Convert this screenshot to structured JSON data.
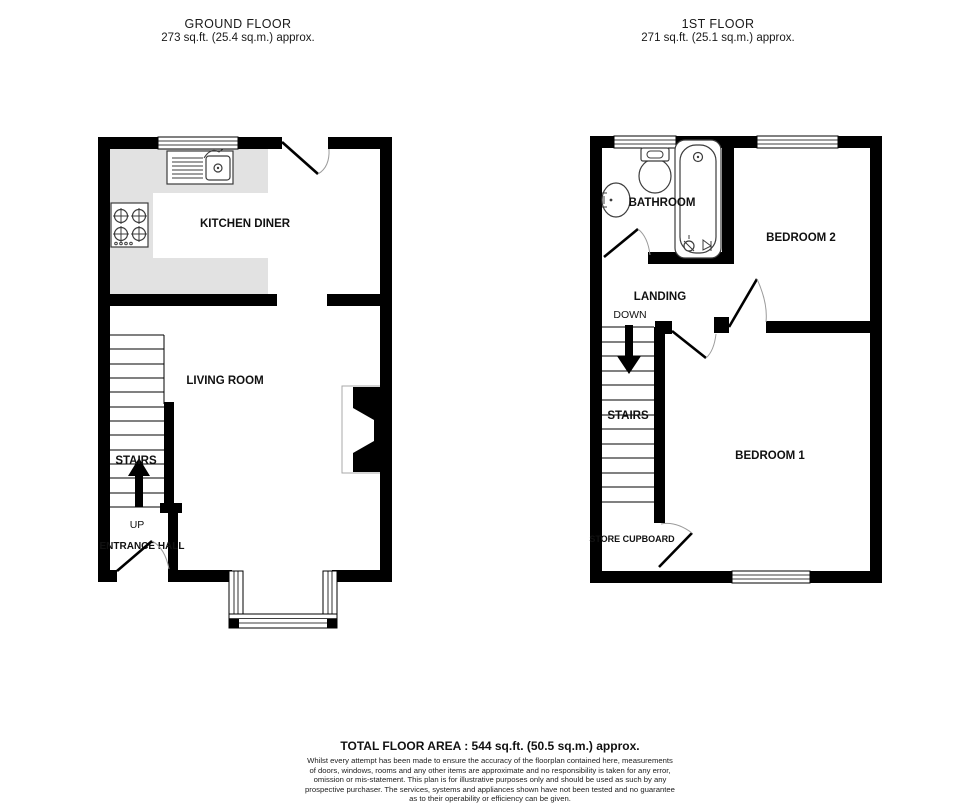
{
  "ground_floor": {
    "title": "GROUND FLOOR",
    "area": "273 sq.ft. (25.4 sq.m.) approx.",
    "labels": {
      "kitchen": "KITCHEN DINER",
      "living": "LIVING ROOM",
      "stairs": "STAIRS",
      "up": "UP",
      "hall": "ENTRANCE HALL"
    }
  },
  "first_floor": {
    "title": "1ST FLOOR",
    "area": "271 sq.ft. (25.1 sq.m.) approx.",
    "labels": {
      "bathroom": "BATHROOM",
      "bedroom2": "BEDROOM 2",
      "landing": "LANDING",
      "down": "DOWN",
      "stairs": "STAIRS",
      "bedroom1": "BEDROOM 1",
      "cupboard": "STORE CUPBOARD"
    }
  },
  "footer": {
    "total": "TOTAL FLOOR AREA : 544 sq.ft. (50.5 sq.m.) approx.",
    "disclaimer_lines": [
      "Whilst every attempt has been made to ensure the accuracy of the floorplan contained here, measurements",
      "of doors, windows, rooms and any other items are approximate and no responsibility is taken for any error,",
      "omission or mis-statement. This plan is for illustrative purposes only and should be used as such by any",
      "prospective purchaser. The services, systems and appliances shown have not been tested and no guarantee",
      "as to their operability or efficiency can be given.",
      "Made with Metropix ©2025"
    ]
  },
  "colors": {
    "wall": "#000000",
    "kitchen_counter": "#e2e2e2",
    "fixture_outline": "#3c3c3c",
    "door_arc": "#9b9b9b"
  }
}
